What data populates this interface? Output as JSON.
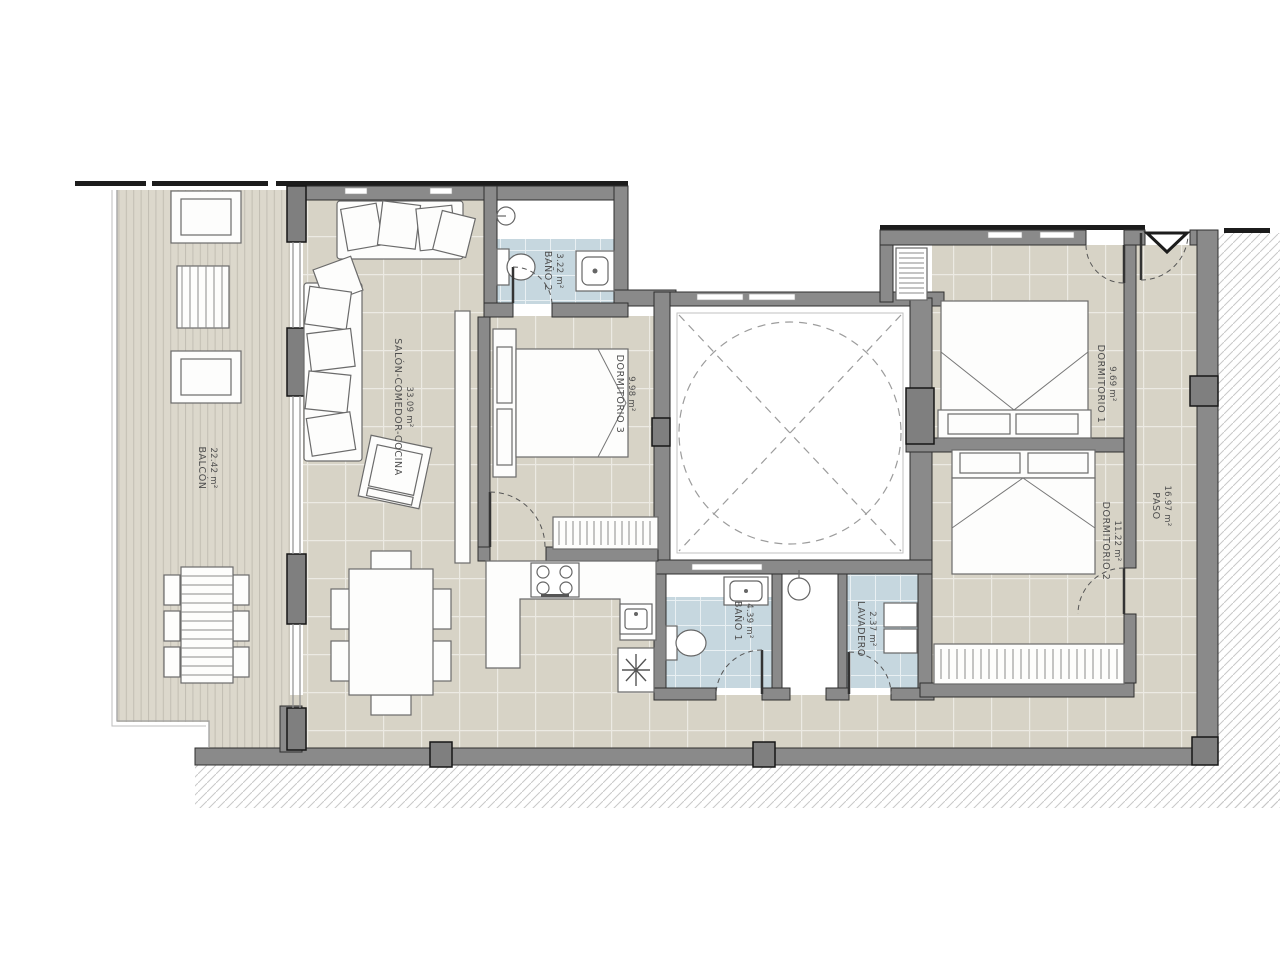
{
  "plan_title": "Apartment floor plan",
  "rooms": [
    {
      "id": "balcon",
      "name": "BALCÓN",
      "area": "22.42 m²"
    },
    {
      "id": "salon",
      "name": "SALÓN-COMEDOR-COCINA",
      "area": "33.09 m²"
    },
    {
      "id": "bano2",
      "name": "BAÑO 2",
      "area": "3.22 m²"
    },
    {
      "id": "dormitorio3",
      "name": "DORMITORIO 3",
      "area": "9.98 m²"
    },
    {
      "id": "dormitorio1",
      "name": "DORMITORIO 1",
      "area": "9.69 m²"
    },
    {
      "id": "paso",
      "name": "PASO",
      "area": "16.97 m²"
    },
    {
      "id": "dormitorio2",
      "name": "DORMITORIO 2",
      "area": "11.22 m²"
    },
    {
      "id": "bano1",
      "name": "BAÑO 1",
      "area": "4.39 m²"
    },
    {
      "id": "lavadero",
      "name": "LAVADERO",
      "area": "2.37 m²"
    }
  ],
  "colors": {
    "wall": "#8a8a8a",
    "wall_edge": "#2f2f2f",
    "floor_tile": "#d7d3c6",
    "deck": "#dcd8cc",
    "wet_tile": "#c6d7df",
    "hatch": "#c8c8c8",
    "label_text": "#4f4f4f"
  }
}
